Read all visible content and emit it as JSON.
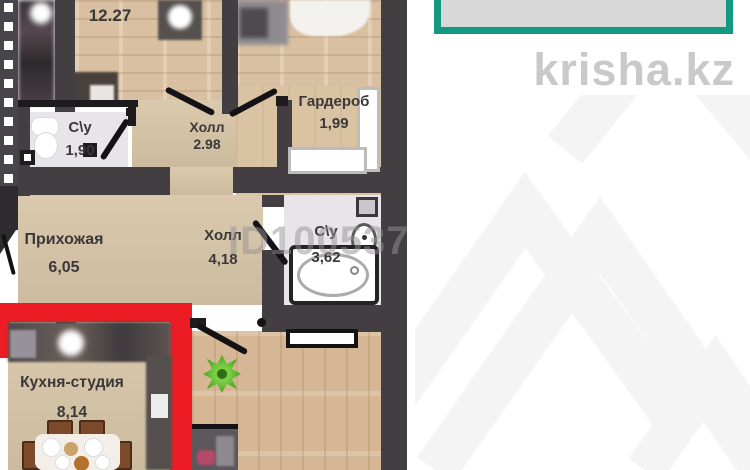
{
  "brand": {
    "logo_text": "krisha.kz"
  },
  "watermark": {
    "listing_id": "ID100537"
  },
  "rooms": {
    "bedroom": {
      "area": "12.27"
    },
    "bath_small": {
      "name": "С\\у",
      "area": "1,90"
    },
    "hall_small": {
      "name": "Холл",
      "area": "2.98"
    },
    "wardrobe": {
      "name": "Гардероб",
      "area": "1,99"
    },
    "entry": {
      "name": "Прихожая",
      "area": "6,05"
    },
    "hall_main": {
      "name": "Холл",
      "area": "4,18"
    },
    "bath_main": {
      "name": "С\\у",
      "area": "3,62"
    },
    "kitchen": {
      "name": "Кухня-студия",
      "area": "8,14"
    }
  },
  "colors": {
    "wall": "#423e41",
    "floor_wood": "#d9c0a2",
    "floor_hall": "#d7c5a7",
    "floor_bath": "#e7e5e9",
    "highlight_red": "#ed1c24",
    "accent_teal": "#13997f",
    "logo_gray": "#c9c9c9",
    "plant_green": "#56b32d"
  }
}
